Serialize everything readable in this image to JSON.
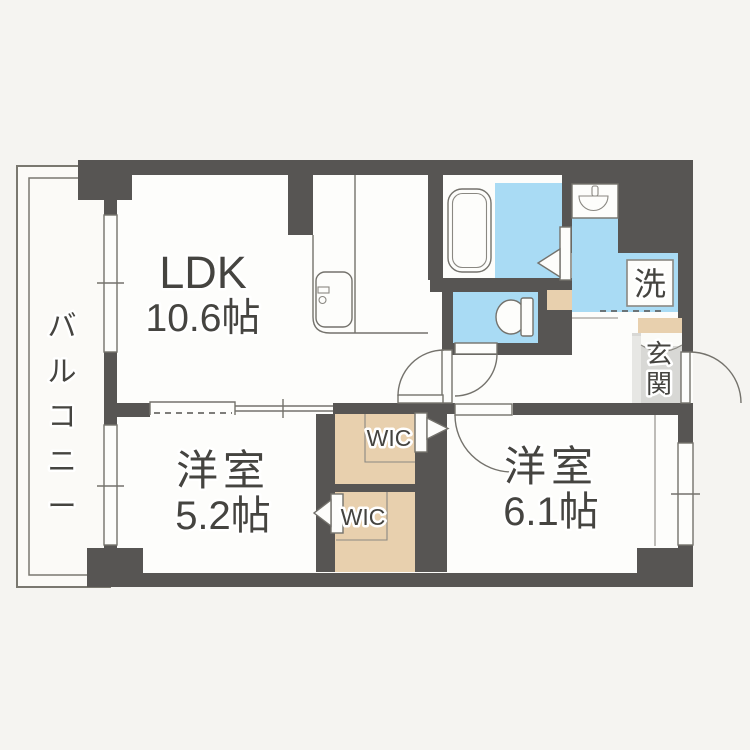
{
  "floor_plan": {
    "rooms": {
      "ldk": {
        "label": "LDK",
        "area": "10.6帖"
      },
      "bedroom_small": {
        "label": "洋室",
        "area": "5.2帖"
      },
      "bedroom_large": {
        "label": "洋室",
        "area": "6.1帖"
      },
      "balcony": {
        "label": "バルコニー"
      },
      "entrance": {
        "label": "玄関"
      },
      "wic_upper": {
        "label": "WIC"
      },
      "wic_lower": {
        "label": "WIC"
      },
      "laundry": {
        "label": "洗"
      }
    },
    "colors": {
      "wall": "#575553",
      "floor": "#fdfdfb",
      "wet_area": "#a9dbf4",
      "storage": "#e8d0ae",
      "entrance_floor": "#d8d8d5",
      "outline": "#74726c",
      "label_text": "#454440",
      "page_background": "#f5f4f1"
    }
  }
}
